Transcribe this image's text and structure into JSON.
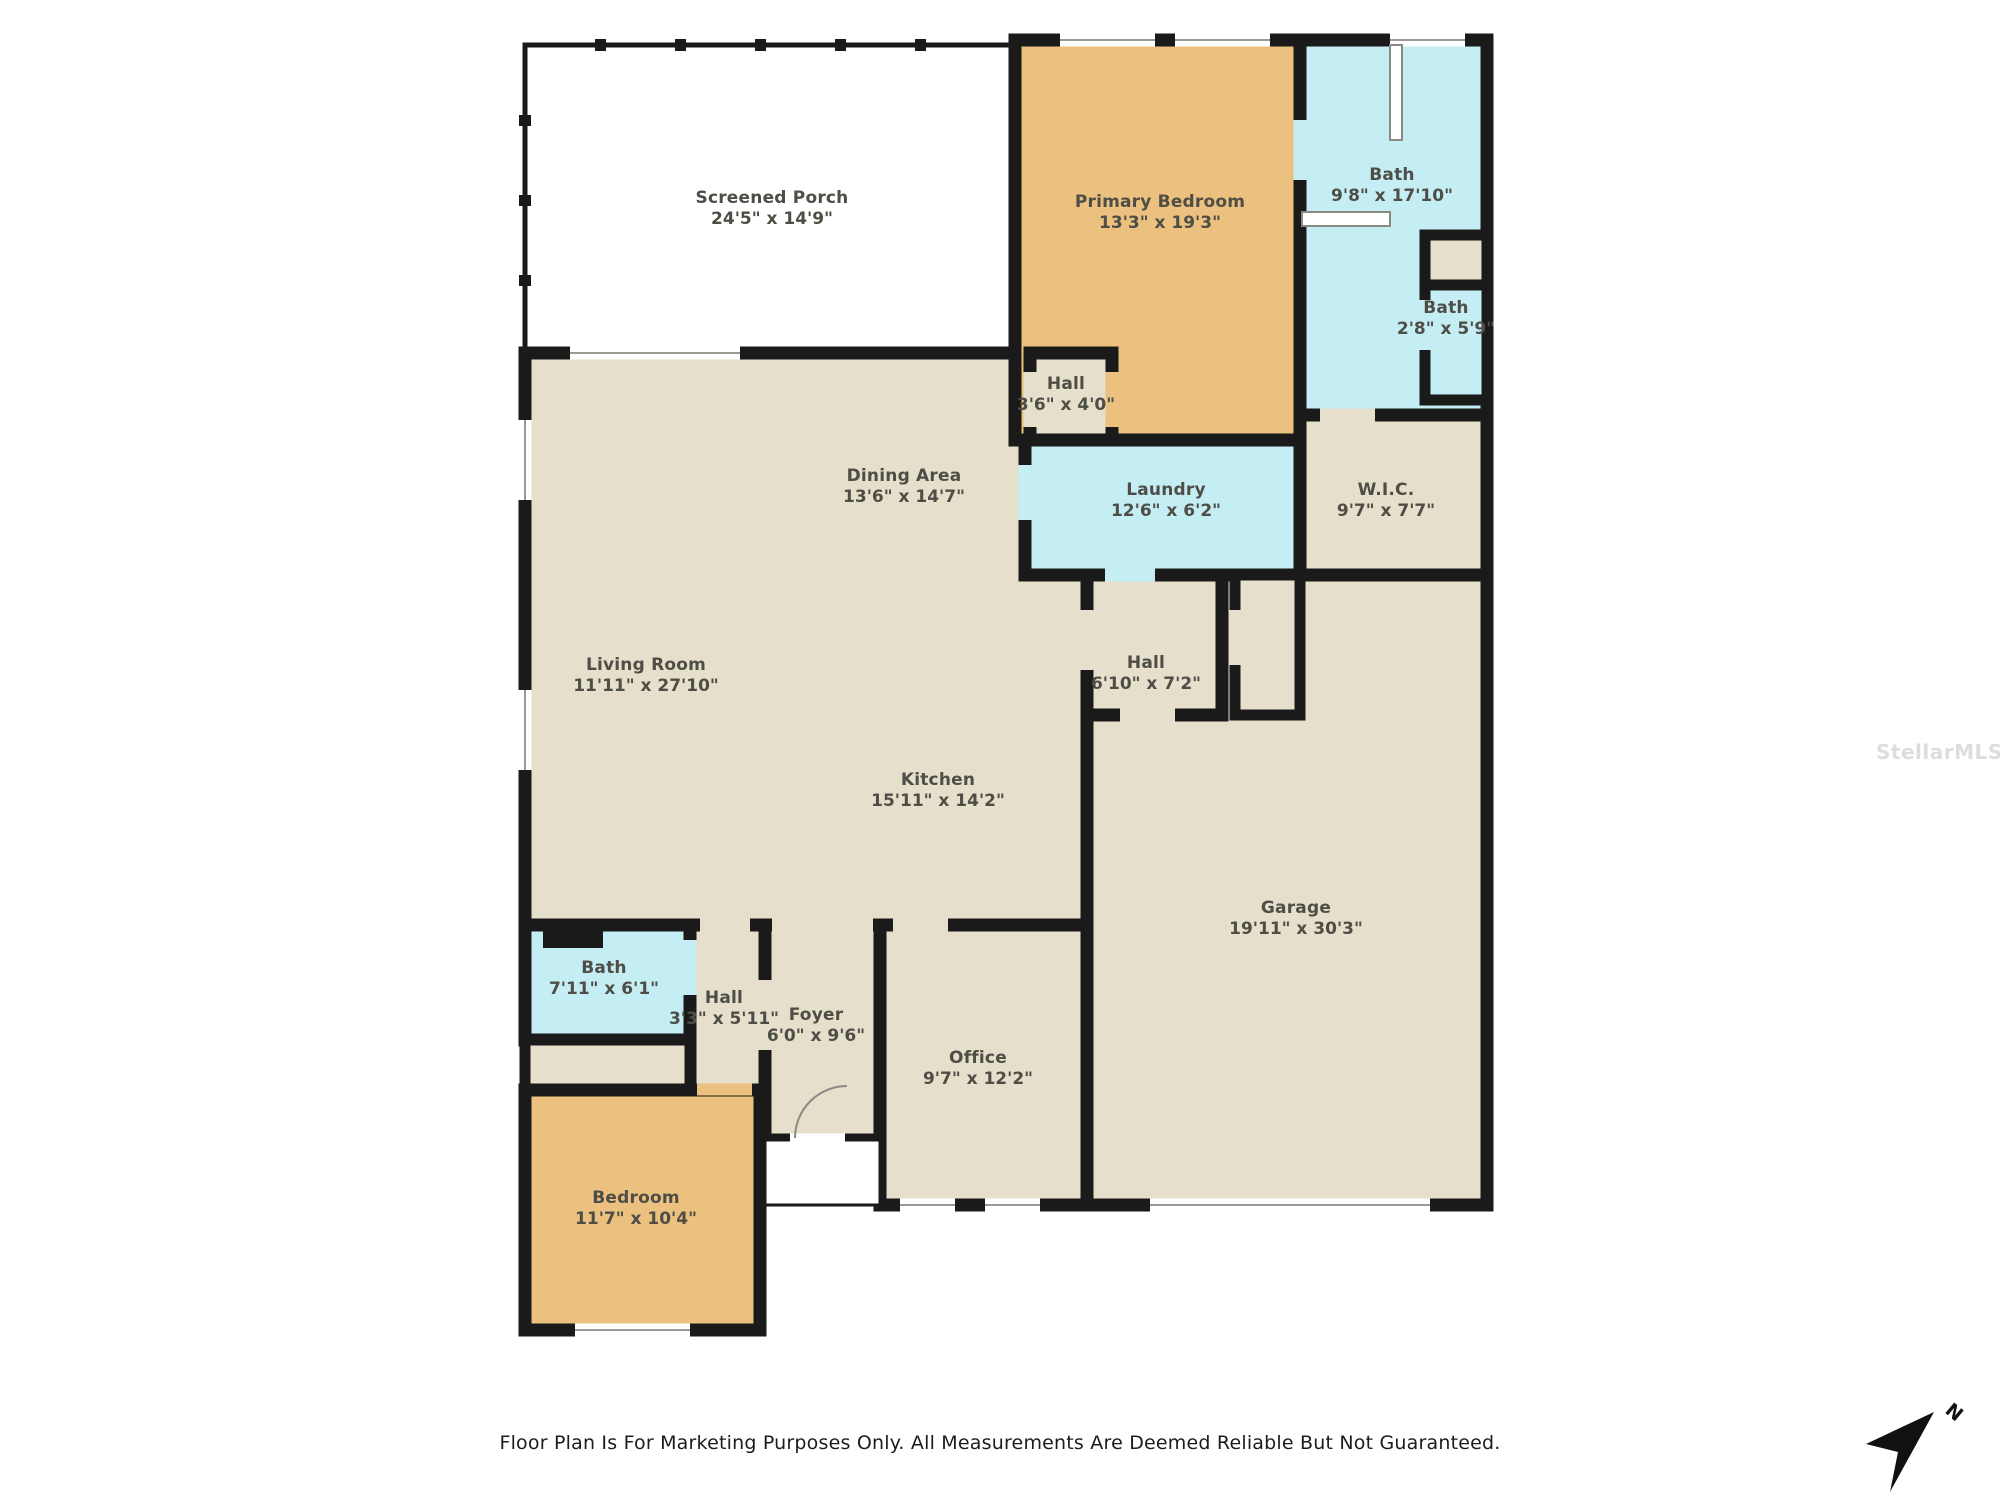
{
  "page": {
    "footer_text": "Floor Plan Is For Marketing Purposes Only. All Measurements Are Deemed Reliable But Not Guaranteed.",
    "watermark": "StellarMLS",
    "compass_label": "N"
  },
  "colors": {
    "wall": "#1a1a1a",
    "room_beige": "#e5dfcb",
    "room_orange": "#ecc17f",
    "room_blue": "#c5edf4",
    "room_white": "#ffffff",
    "label_text": "#4e4e46"
  },
  "rooms": [
    {
      "id": "screened-porch",
      "name": "Screened Porch",
      "dims": "24'5\" x 14'9\""
    },
    {
      "id": "primary-bedroom",
      "name": "Primary Bedroom",
      "dims": "13'3\" x 19'3\""
    },
    {
      "id": "primary-bath",
      "name": "Bath",
      "dims": "9'8\" x 17'10\""
    },
    {
      "id": "small-bath",
      "name": "Bath",
      "dims": "2'8\" x 5'9\""
    },
    {
      "id": "hall-primary",
      "name": "Hall",
      "dims": "3'6\" x 4'0\""
    },
    {
      "id": "laundry",
      "name": "Laundry",
      "dims": "12'6\" x 6'2\""
    },
    {
      "id": "wic",
      "name": "W.I.C.",
      "dims": "9'7\" x 7'7\""
    },
    {
      "id": "dining-area",
      "name": "Dining Area",
      "dims": "13'6\" x 14'7\""
    },
    {
      "id": "living-room",
      "name": "Living Room",
      "dims": "11'11\" x 27'10\""
    },
    {
      "id": "hall-center",
      "name": "Hall",
      "dims": "6'10\" x 7'2\""
    },
    {
      "id": "kitchen",
      "name": "Kitchen",
      "dims": "15'11\" x 14'2\""
    },
    {
      "id": "garage",
      "name": "Garage",
      "dims": "19'11\" x 30'3\""
    },
    {
      "id": "guest-bath",
      "name": "Bath",
      "dims": "7'11\" x 6'1\""
    },
    {
      "id": "hall-foyer",
      "name": "Hall",
      "dims": "3'3\" x 5'11\""
    },
    {
      "id": "foyer",
      "name": "Foyer",
      "dims": "6'0\" x 9'6\""
    },
    {
      "id": "office",
      "name": "Office",
      "dims": "9'7\" x 12'2\""
    },
    {
      "id": "bedroom",
      "name": "Bedroom",
      "dims": "11'7\" x 10'4\""
    }
  ]
}
